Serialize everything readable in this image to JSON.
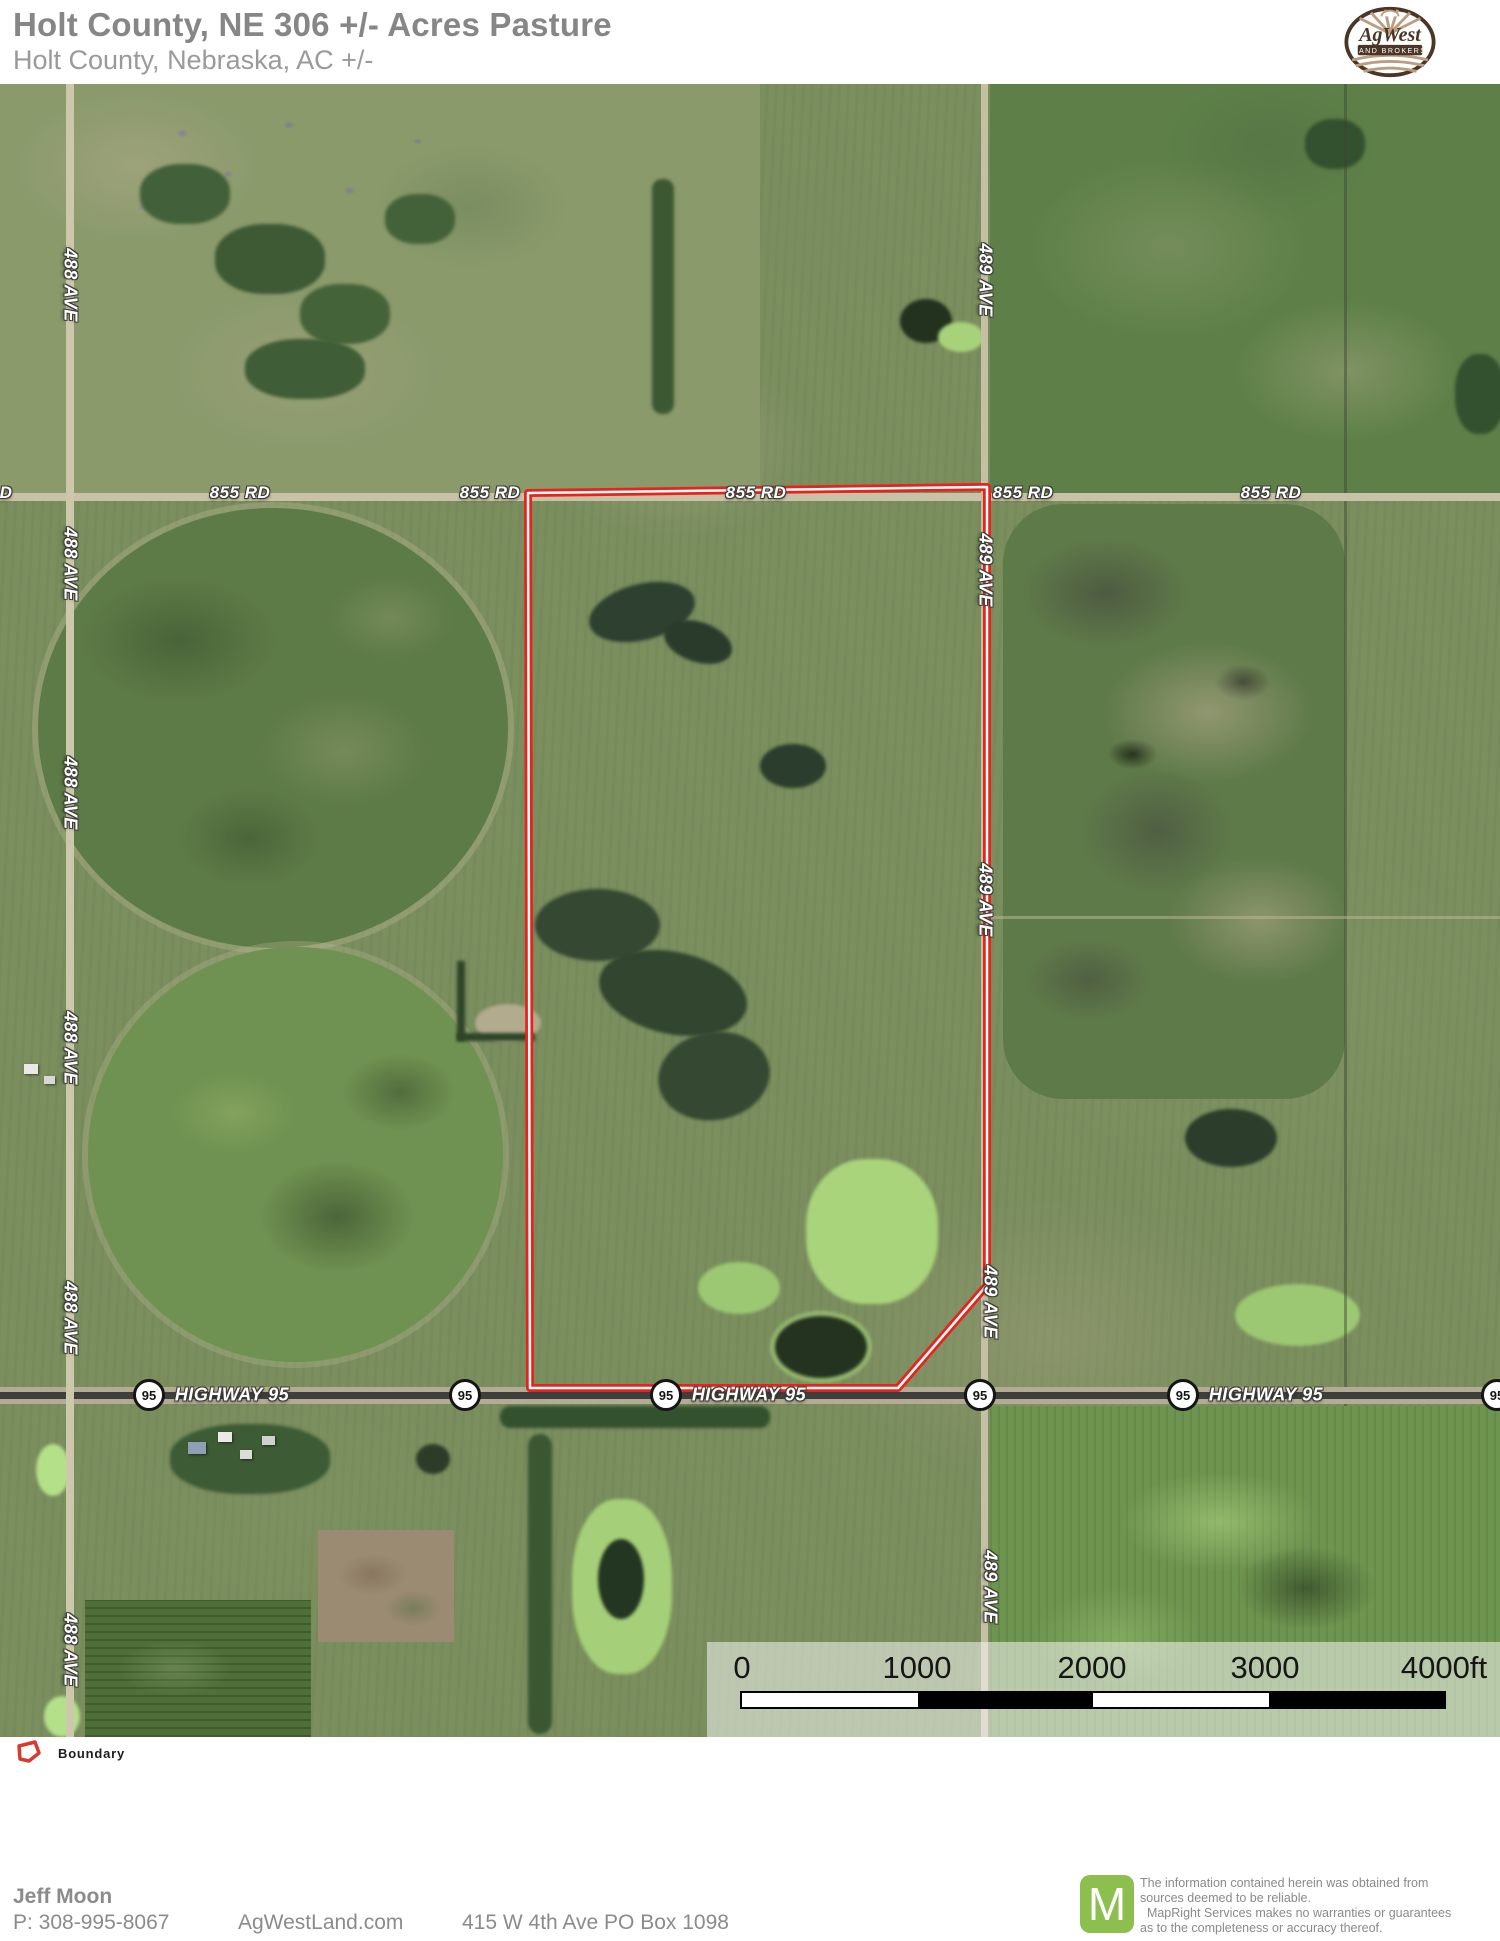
{
  "header": {
    "title": "Holt County, NE 306 +/- Acres Pasture",
    "subtitle": "Holt County, Nebraska,  AC +/-"
  },
  "brand": {
    "logo_name": "AgWest",
    "logo_tagline": "LAND BROKERS"
  },
  "map": {
    "roads": {
      "rd855": "855 RD",
      "rd855_partial": "D",
      "ave488": "488 AVE",
      "ave489": "489 AVE",
      "highway": "HIGHWAY 95",
      "shield": "95"
    },
    "scalebar": {
      "ticks": [
        "0",
        "1000",
        "2000",
        "3000",
        "4000ft"
      ]
    }
  },
  "legend": {
    "boundary": "Boundary"
  },
  "footer": {
    "agent": "Jeff Moon",
    "phone": "P: 308-995-8067",
    "website": "AgWestLand.com",
    "address": "415 W 4th Ave PO Box 1098",
    "mapright_m": "M",
    "disclaimer": [
      "The information contained herein was obtained from",
      "sources deemed to be reliable.",
      "  MapRight Services makes no warranties or guarantees",
      "as to the completeness or accuracy thereof."
    ]
  },
  "colors": {
    "boundary_red": "#e8221c",
    "mapright_green": "#8cbf4d",
    "logo_brown": "#4a3526"
  }
}
